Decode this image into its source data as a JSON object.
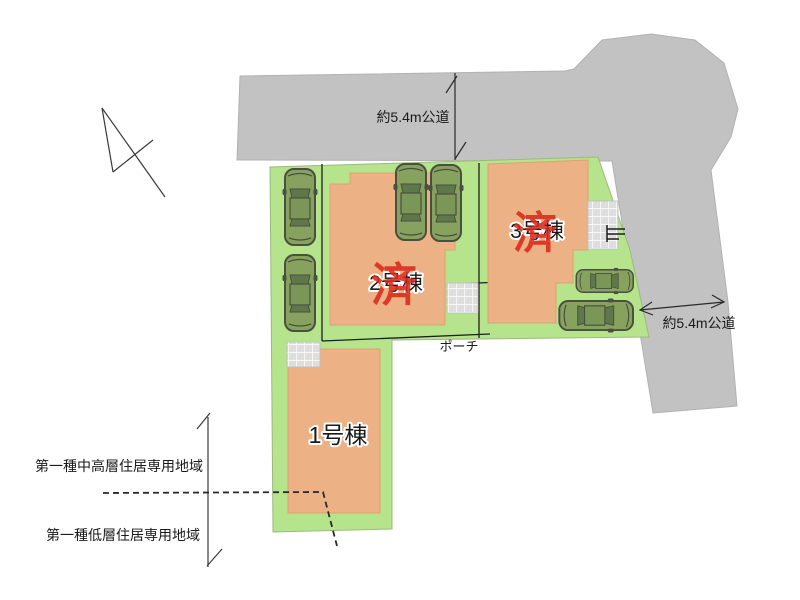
{
  "plan_type": "residential-site-plan",
  "roads": {
    "top": {
      "label": "約5.4m公道"
    },
    "right": {
      "label": "約5.4m公道"
    }
  },
  "buildings": [
    {
      "id": "1",
      "label": "1号棟",
      "stamp": ""
    },
    {
      "id": "2",
      "label": "2号棟",
      "stamp": "済"
    },
    {
      "id": "3",
      "label": "3号棟",
      "stamp": "済"
    }
  ],
  "porch": {
    "label": "ポーチ"
  },
  "zoning": {
    "upper_label": "第一種中高層住居専用地域",
    "lower_label": "第一種低層住居専用地域"
  },
  "counts": {
    "cars": 6
  },
  "colors": {
    "road_gray": "#c2c2c2",
    "lot_green": "#b5e48c",
    "building_tan": "#ecb184",
    "car_green": "#86a25e",
    "stamp_red": "#dc291b",
    "porch_tile": "#dedede"
  }
}
